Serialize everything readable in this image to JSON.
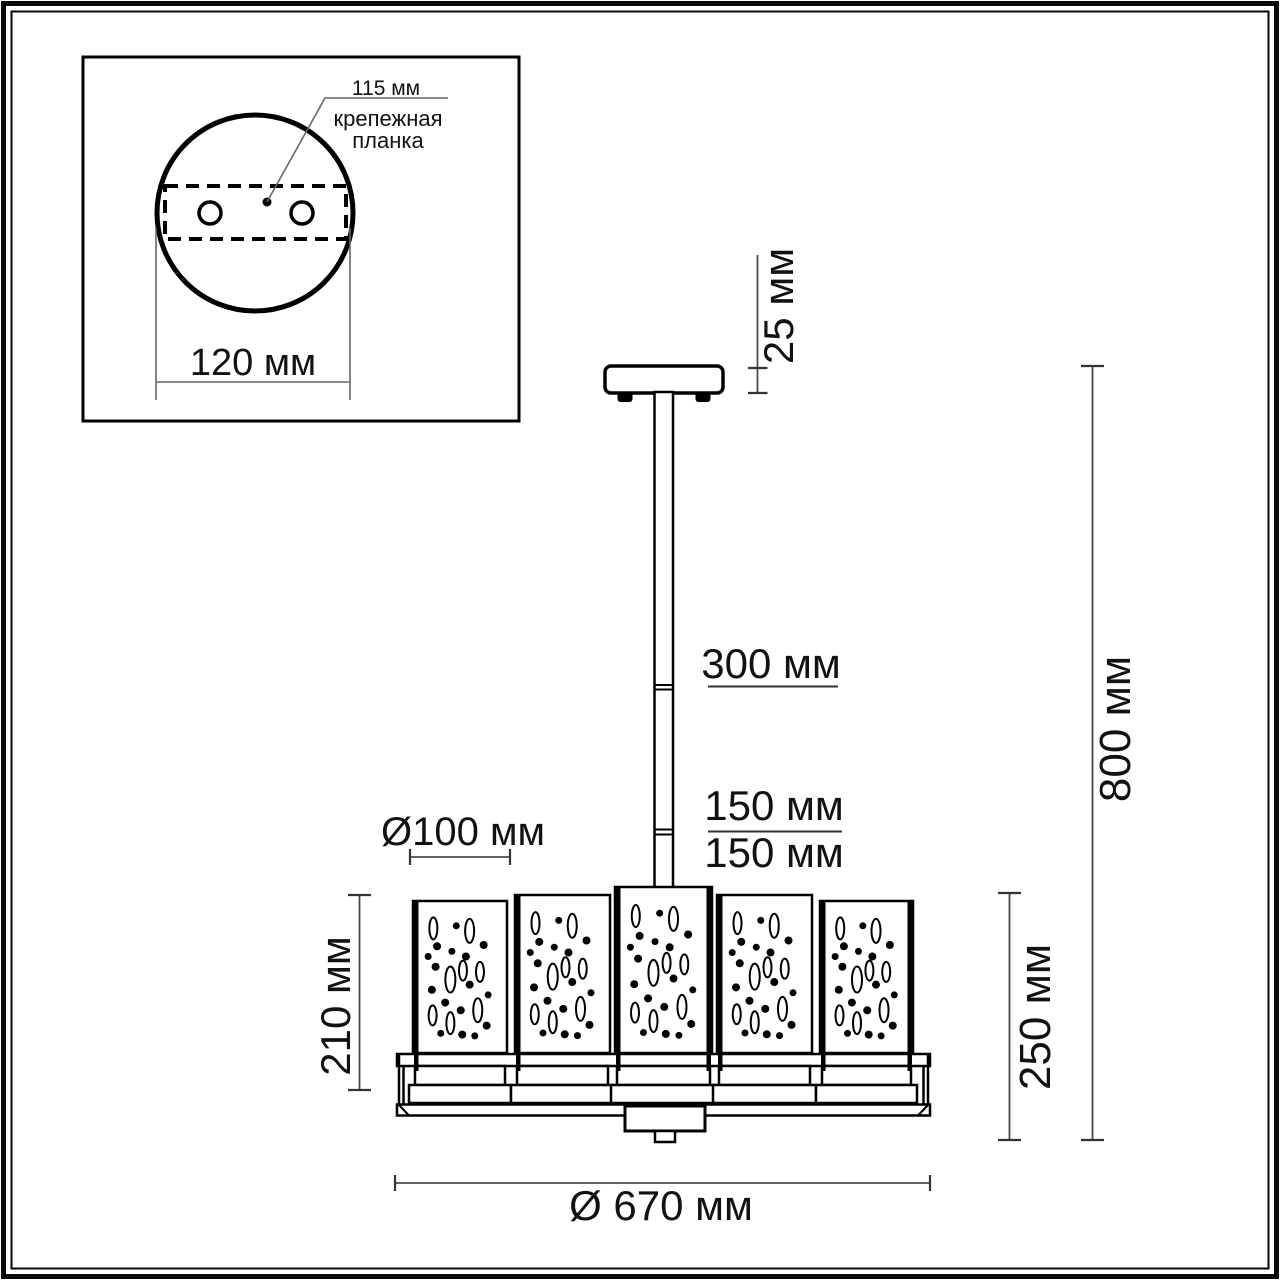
{
  "page": {
    "background": "#ffffff",
    "line_color": "#000000",
    "dim_line_color": "#4a4a4a",
    "text_color": "#121212"
  },
  "inset": {
    "plate_length_label": "115 мм",
    "plate_name_line1": "крепежная",
    "plate_name_line2": "планка",
    "canopy_diameter_label": "120 мм"
  },
  "dimensions": {
    "canopy_height": "25 мм",
    "rod_segment_upper": "300 мм",
    "rod_segment_mid": "150 мм",
    "rod_segment_lower": "150 мм",
    "shade_diameter": "Ø100 мм",
    "shade_height": "210 мм",
    "body_height": "250 мм",
    "total_height": "800 мм",
    "total_diameter": "Ø 670 мм"
  },
  "shades": {
    "count": 5,
    "bottom": 1053,
    "boxes": [
      {
        "x": 413,
        "y": 901,
        "w": 94
      },
      {
        "x": 515,
        "y": 895,
        "w": 95
      },
      {
        "x": 615,
        "y": 887,
        "w": 97
      },
      {
        "x": 717,
        "y": 895,
        "w": 95
      },
      {
        "x": 820,
        "y": 901,
        "w": 93
      }
    ],
    "strips": [
      [
        "left"
      ],
      [
        "left"
      ],
      [
        "left",
        "right"
      ],
      [
        "left"
      ],
      [
        "left",
        "right"
      ]
    ],
    "pattern": [
      {
        "t": "o",
        "x": 0.14,
        "y": 0.12,
        "rx": 4,
        "ry": 11
      },
      {
        "t": "o",
        "x": 0.63,
        "y": 0.14,
        "rx": 4.5,
        "ry": 12
      },
      {
        "t": "d",
        "x": 0.45,
        "y": 0.1,
        "r": 3.5
      },
      {
        "t": "d",
        "x": 0.19,
        "y": 0.26,
        "r": 4
      },
      {
        "t": "d",
        "x": 0.82,
        "y": 0.25,
        "r": 4
      },
      {
        "t": "d",
        "x": 0.39,
        "y": 0.3,
        "r": 3.5
      },
      {
        "t": "d",
        "x": 0.58,
        "y": 0.34,
        "r": 4
      },
      {
        "t": "d",
        "x": 0.07,
        "y": 0.34,
        "r": 3.5
      },
      {
        "t": "d",
        "x": 0.17,
        "y": 0.42,
        "r": 4
      },
      {
        "t": "o",
        "x": 0.54,
        "y": 0.45,
        "rx": 4,
        "ry": 10
      },
      {
        "t": "o",
        "x": 0.77,
        "y": 0.46,
        "rx": 4,
        "ry": 10
      },
      {
        "t": "o",
        "x": 0.37,
        "y": 0.52,
        "rx": 5,
        "ry": 13
      },
      {
        "t": "d",
        "x": 0.63,
        "y": 0.56,
        "r": 4
      },
      {
        "t": "d",
        "x": 0.12,
        "y": 0.6,
        "r": 4
      },
      {
        "t": "d",
        "x": 0.88,
        "y": 0.64,
        "r": 3.5
      },
      {
        "t": "d",
        "x": 0.3,
        "y": 0.7,
        "r": 4
      },
      {
        "t": "d",
        "x": 0.51,
        "y": 0.76,
        "r": 4
      },
      {
        "t": "o",
        "x": 0.74,
        "y": 0.76,
        "rx": 4.5,
        "ry": 12
      },
      {
        "t": "o",
        "x": 0.13,
        "y": 0.8,
        "rx": 4,
        "ry": 10
      },
      {
        "t": "o",
        "x": 0.37,
        "y": 0.86,
        "rx": 4,
        "ry": 11
      },
      {
        "t": "d",
        "x": 0.86,
        "y": 0.88,
        "r": 4
      },
      {
        "t": "d",
        "x": 0.24,
        "y": 0.94,
        "r": 3.5
      },
      {
        "t": "d",
        "x": 0.53,
        "y": 0.95,
        "r": 4
      },
      {
        "t": "d",
        "x": 0.7,
        "y": 0.96,
        "r": 3.5
      }
    ]
  }
}
